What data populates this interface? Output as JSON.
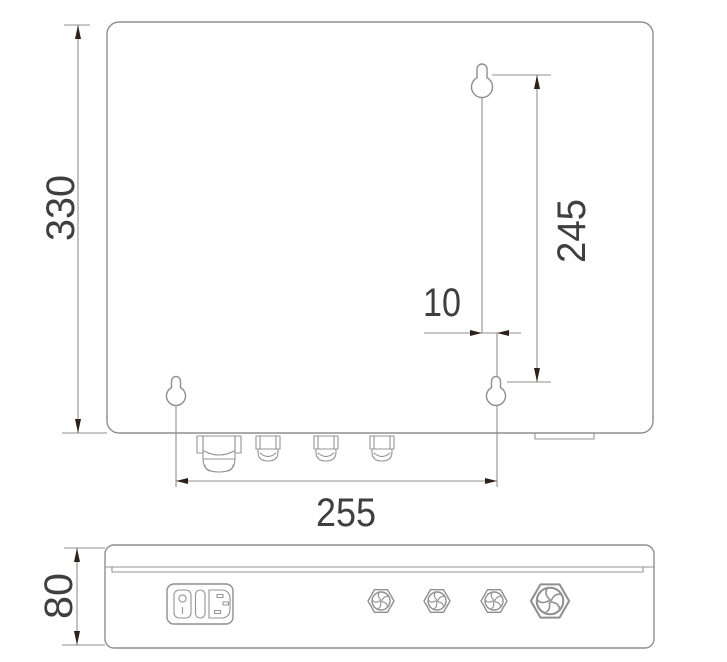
{
  "drawing": {
    "kind": "enclosure technical drawing, two orthographic views",
    "colors": {
      "background": "#ffffff",
      "outline": "#8f8f8f",
      "dimension_line": "#8f8f8f",
      "arrow": "#2f2018",
      "text": "#3f3f3f"
    },
    "dims": {
      "overall_height": "330",
      "vertical_hole_pitch": "245",
      "hole_offset": "10",
      "horizontal_hole_pitch": "255",
      "enclosure_depth": "80"
    },
    "views": {
      "rear": {
        "features": [
          "keyhole-mount-slot-top",
          "keyhole-mount-slot-bottom-left",
          "keyhole-mount-slot-bottom-right",
          "cable-gland-large",
          "cable-gland-small-1",
          "cable-gland-small-2",
          "cable-gland-small-3",
          "bottom-edge-tab"
        ]
      },
      "bottom": {
        "features": [
          "rocker-power-switch",
          "fuse-holder",
          "iec-power-inlet",
          "gland-nut-small-1",
          "gland-nut-small-2",
          "gland-nut-small-3",
          "gland-nut-large"
        ]
      }
    }
  }
}
